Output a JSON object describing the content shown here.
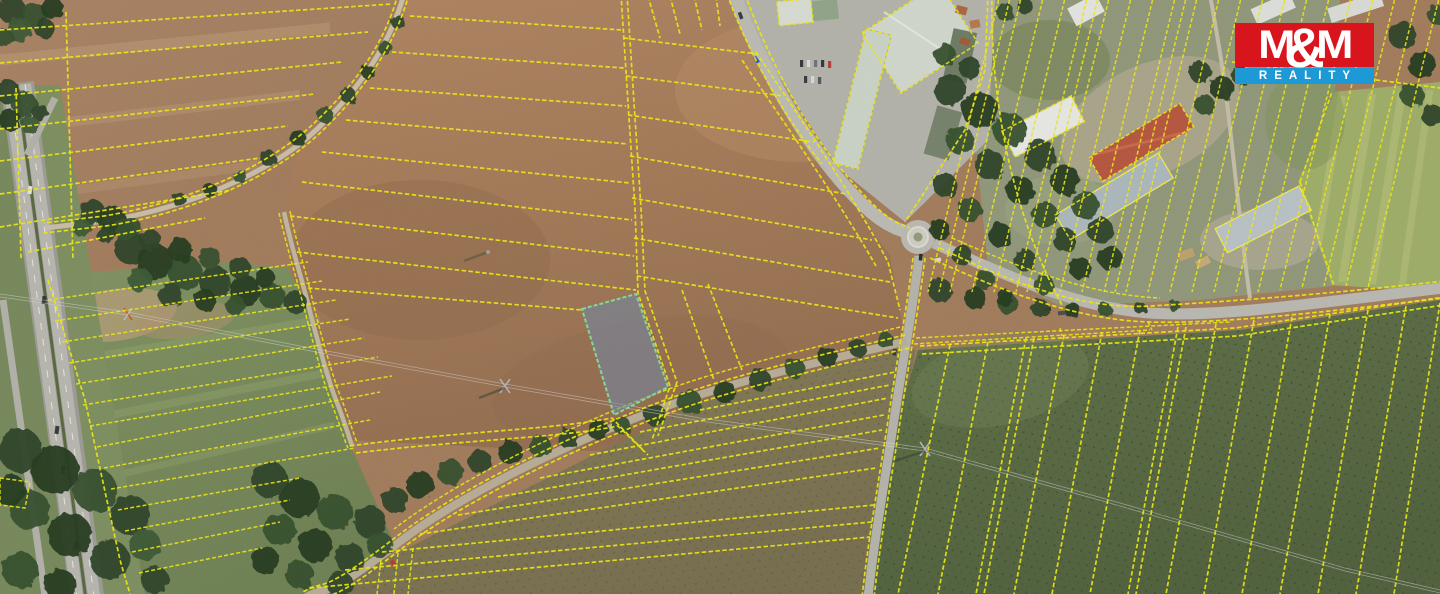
{
  "page": {
    "kind": "aerial-photo-with-cadastral-overlay",
    "width": 1440,
    "height": 594
  },
  "logo": {
    "m1": "M",
    "amp": "&",
    "m2": "M",
    "reality": "REALITY",
    "red": "#d8151d",
    "blue": "#1d9ad6",
    "text_color": "#ffffff"
  },
  "map": {
    "cadastral_line_color": "#ebe70e",
    "highlighted_parcel": {
      "fill": "#6d87a8",
      "fill_opacity": "0.55",
      "stroke": "#82d89b"
    },
    "features": [
      "highway-left",
      "frontage-road",
      "rural-lane",
      "field-track",
      "roundabout",
      "north-road",
      "east-road",
      "south-road",
      "southwest-road",
      "industrial-buildings",
      "farm-buildings",
      "tree-bands",
      "power-line",
      "plowed-fields",
      "green-pastures",
      "strip-parcels",
      "highlighted-parcel"
    ]
  }
}
